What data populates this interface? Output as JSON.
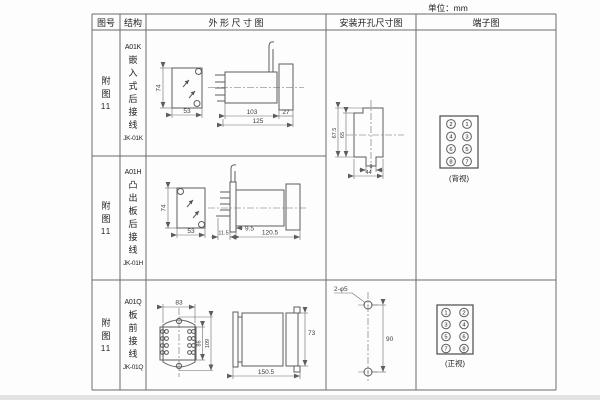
{
  "page": {
    "unit": "单位：mm"
  },
  "table": {
    "headers": [
      "图号",
      "结构",
      "外 形 尺 寸 图",
      "安装开孔尺寸图",
      "端子图"
    ]
  },
  "rows": [
    {
      "fig": "附图",
      "fig_num": "11",
      "model": "A01K",
      "struct_text": "嵌入式后接线",
      "code": "JK-01K",
      "dims": {
        "h": "74",
        "w": "53",
        "body": "103",
        "rear": "27",
        "total": "125"
      }
    },
    {
      "fig": "附图",
      "fig_num": "11",
      "model": "A01H",
      "struct_text": "凸出板后接线",
      "code": "JK-01H",
      "dims": {
        "h": "74",
        "w": "53",
        "front": "11.5",
        "proj": "9.5",
        "depth": "120.5"
      }
    },
    {
      "fig": "附图",
      "fig_num": "11",
      "model": "A01Q",
      "struct_text": "板前接线",
      "code": "JK-01Q",
      "dims": {
        "w": "83",
        "inner_h": "86",
        "outer_h": "109",
        "h": "73",
        "depth": "150.5"
      }
    }
  ],
  "mounting": {
    "cutout": {
      "outer_h": "67.5",
      "inner_h": "65",
      "slot_w": "9",
      "w": "44"
    },
    "holes": {
      "label": "2-φ5",
      "spacing": "90"
    }
  },
  "terminals": {
    "rear": {
      "left": [
        "2",
        "4",
        "6",
        "8"
      ],
      "right": [
        "1",
        "3",
        "5",
        "7"
      ],
      "caption": "(背视)"
    },
    "front": {
      "left": [
        "1",
        "3",
        "5",
        "7"
      ],
      "right": [
        "2",
        "4",
        "6",
        "8"
      ],
      "caption": "(正视)"
    }
  }
}
